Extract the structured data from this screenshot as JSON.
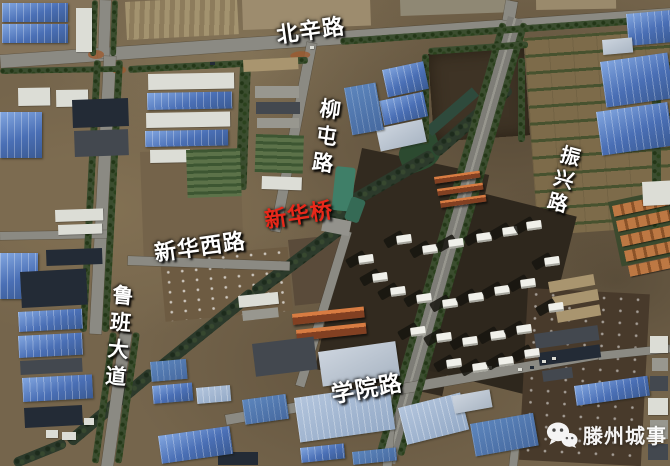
{
  "image_type": "satellite-map",
  "labels": {
    "beixin_road": "北辛路",
    "liutun_road": "柳屯路",
    "zhenxing_road": "振兴路",
    "xinhua_bridge": "新华桥",
    "xinhuaxi_road": "新华西路",
    "luban_avenue": "鲁班大道",
    "xueyuan_road": "学院路"
  },
  "watermark": {
    "text": "滕州城事",
    "icon": "wechat-logo"
  },
  "colors": {
    "road_label": "#ffffff",
    "bridge_label": "#e8281a",
    "road_surface": "#8b8a83",
    "canal_water": "#3f7f68",
    "blue_roof": "#4a6fb5"
  }
}
